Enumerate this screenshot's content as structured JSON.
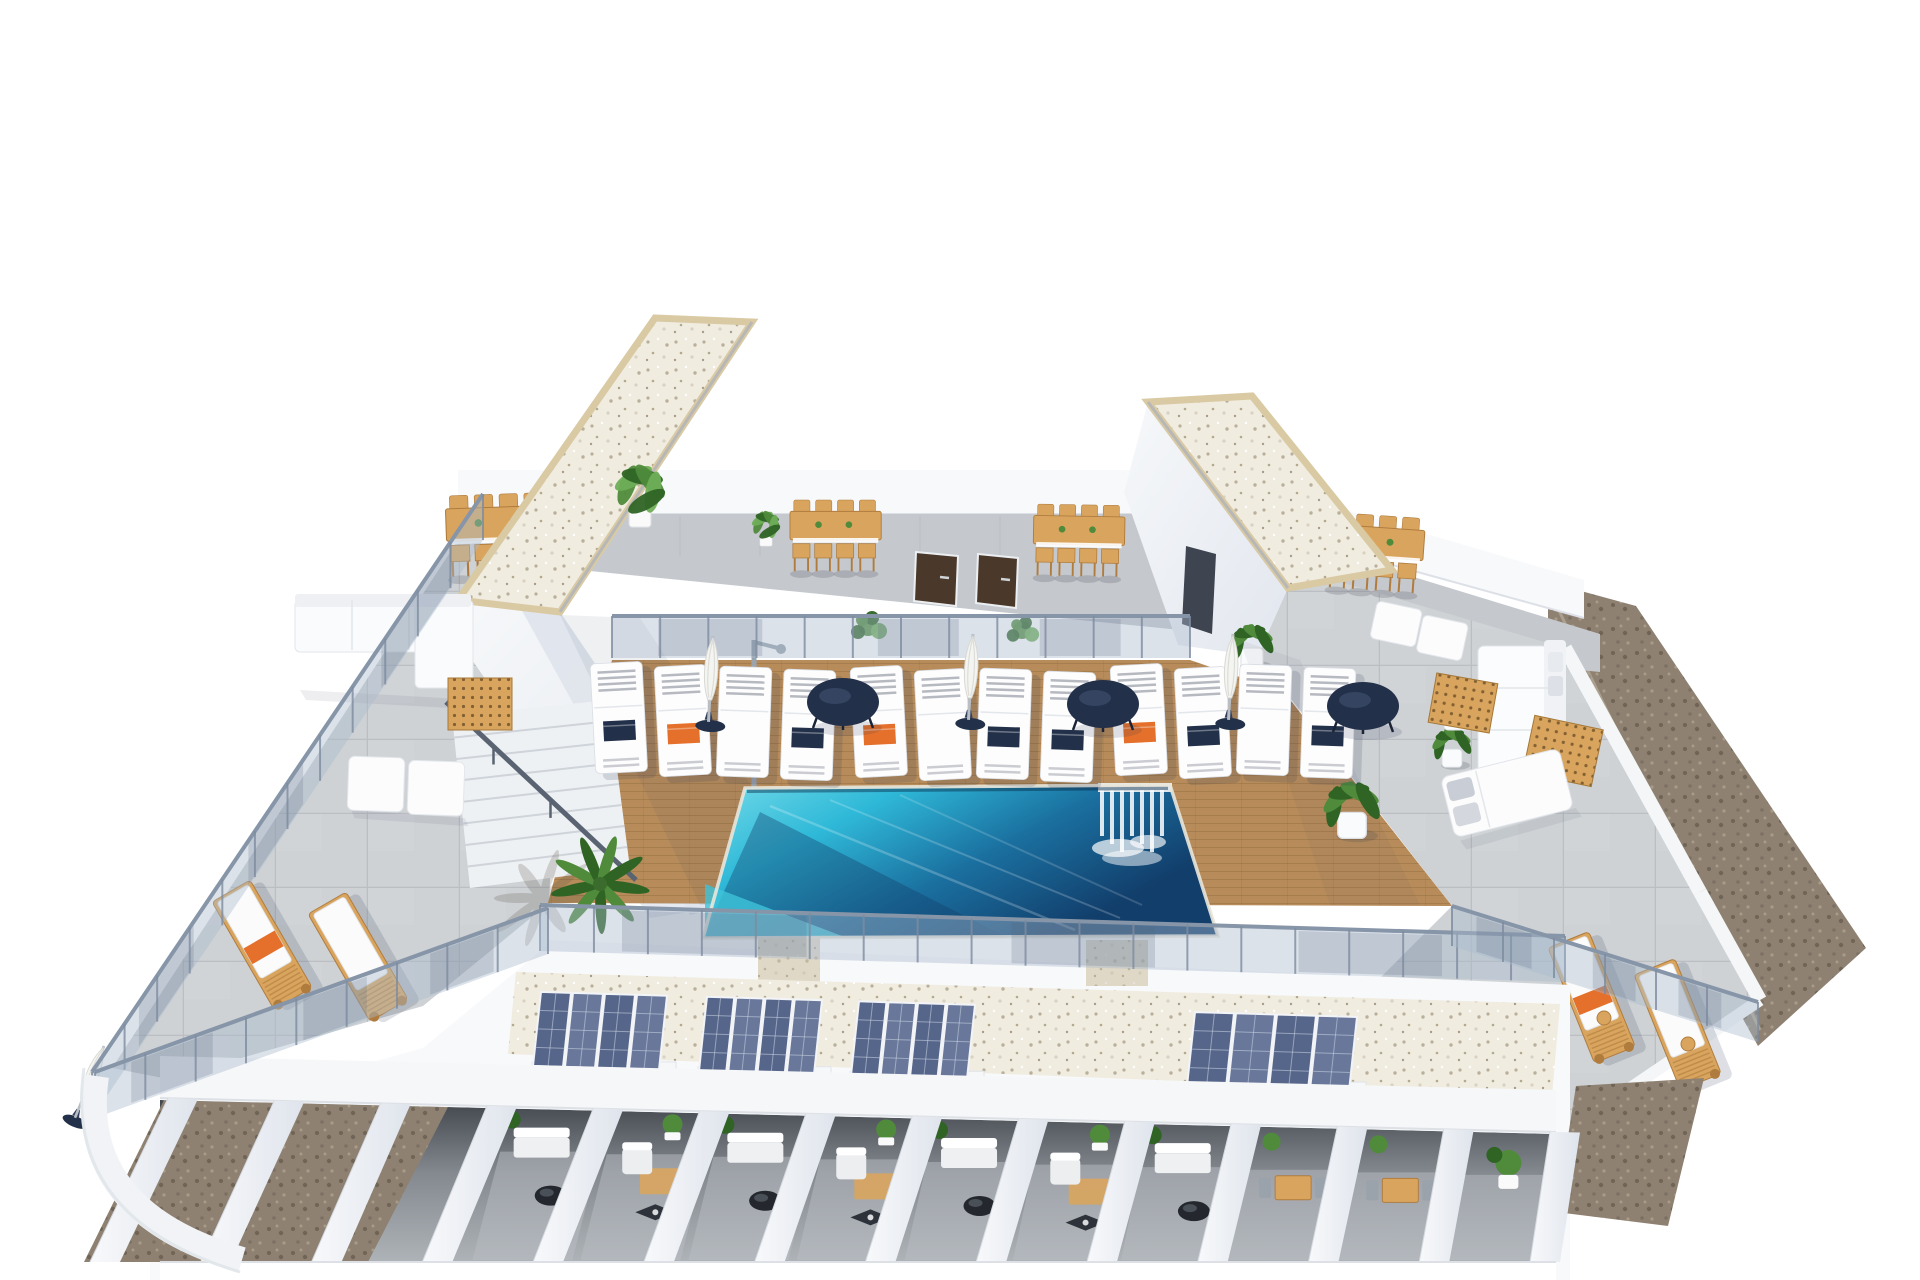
{
  "scene": {
    "title": "Aerial 3D render - rooftop communal terrace with swimming pool",
    "description": "Architectural visualization of an apartment building roof terrace: central wood deck with turquoise pool and waterfall jets, white sun loungers with parasols, two gravel-roof stair towers, wooden dining sets, stone-tile wing terraces with white lounge furniture, solar panel arrays over a white pergola with private patios below, glass balustrades and gravel ground borders.",
    "view": "aerial three-quarter",
    "background": "#ffffff"
  },
  "palette": {
    "wall_white": "#f8f9fb",
    "wall_soft": "#eef0f4",
    "wall_shade": "#dfe4ec",
    "wall_dark": "#c9cfdb",
    "tile_base": "#ced2d5",
    "tile_line": "#b7bcc1",
    "walkway": "#c5c9cd",
    "deck_wood": "#b78c5a",
    "deck_line": "#7a5526",
    "pool_light": "#74dbe9",
    "pool_mid": "#2fb9d8",
    "pool_deep": "#1a6f9f",
    "pool_navy": "#123e6b",
    "glass": "#a9b9cc",
    "glass_frame": "#8795a8",
    "gravel_white": "#f1ece0",
    "gravel_fleck": "#b9b09c",
    "gravel_edge": "#d9caa4",
    "gravel_brown": "#8e8172",
    "gravel_brown_dark": "#6f6456",
    "solar_dark": "#56658a",
    "solar_mid": "#68779a",
    "solar_grid": "#cdd6e4",
    "navy": "#223049",
    "orange": "#e4702b",
    "green": "#4f8b3b",
    "green_dark": "#2f6425",
    "green_light": "#6fae57",
    "wood": "#d9a55e",
    "wood_dark": "#b07c3e",
    "door": "#4a382a",
    "steel": "#9aa4ae"
  },
  "amenities": {
    "pool": {
      "name": "swimming pool",
      "water": "turquoise fading to deep navy",
      "feature": "waterfall jets at right end"
    },
    "pool_loungers": {
      "pairs": 6,
      "per_pair": 2,
      "color": "white",
      "towels": [
        [
          "navy",
          "orange"
        ],
        [
          "none",
          "navy"
        ],
        [
          "orange",
          "none"
        ],
        [
          "navy",
          "navy"
        ],
        [
          "orange",
          "navy"
        ],
        [
          "none",
          "navy"
        ]
      ]
    },
    "parasols": {
      "count": 3,
      "state": "closed",
      "color": "white",
      "base": "navy"
    },
    "side_tables": {
      "count": 3,
      "color": "navy",
      "shape": "round"
    },
    "dining_sets": {
      "count": 4,
      "chairs_per_set": 8,
      "material": "light wood"
    },
    "roof_access_towers": {
      "count": 2,
      "roof_finish": "white gravel with sand border"
    },
    "storage_doors": {
      "count": 2,
      "color": "dark walnut"
    },
    "solar_arrays": {
      "count": 4,
      "panels_per_array": 4
    },
    "pergola": {
      "fin_count": 14,
      "gravel_gaps": 3,
      "patio_scenes": [
        "sofa-table",
        "armchair-rug",
        "sofa-table",
        "armchair-rug",
        "sofa-table",
        "armchair-rug",
        "sofa-table",
        "table-chairs",
        "table-chairs",
        "plant-only"
      ]
    },
    "wing_terraces": {
      "count": 2,
      "floor": "large stone tiles",
      "items": "white sofas, daybeds, wooden vent grates"
    },
    "wood_sun_loungers": {
      "left_pair": 2,
      "right_pair": 2,
      "accent": "orange towel"
    },
    "stairs": {
      "count": 1,
      "handrail": "dark steel"
    },
    "outdoor_shower": {
      "count": 1,
      "finish": "chrome"
    },
    "planters": {
      "count": 8,
      "types": "palms, banana plants, shrubs in white pots"
    }
  }
}
